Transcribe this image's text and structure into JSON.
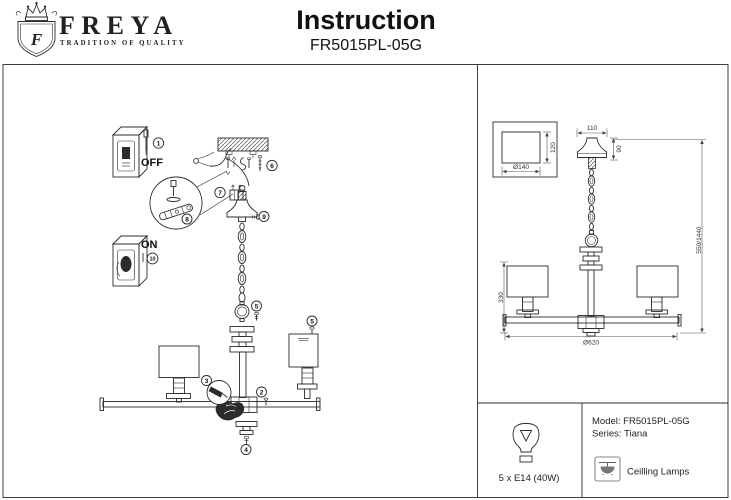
{
  "header": {
    "brand": "FREYA",
    "tagline": "TRADITION OF QUALITY",
    "logo_letter": "F",
    "title": "Instruction",
    "model": "FR5015PL-05G"
  },
  "assembly": {
    "off_label": "OFF",
    "on_label": "ON",
    "steps": {
      "s1": "1",
      "s2": "2",
      "s3": "3",
      "s4": "4",
      "s5": "5",
      "s5b": "5",
      "s6": "6",
      "s7": "7",
      "s8": "8",
      "s9": "9",
      "s10": "10"
    }
  },
  "dimensions": {
    "canopy_front_width": "110",
    "canopy_front_height": "90",
    "canopy_plan_diameter": "Ø140",
    "canopy_plan_side": "120",
    "hanging_height": "550/1440",
    "body_height": "330",
    "total_diameter": "Ø620"
  },
  "spec_table": {
    "bulbs": "5 x E14 (40W)",
    "model": "Model: FR5015PL-05G",
    "series": "Series: Tiana",
    "category": "Ceilling Lamps"
  }
}
